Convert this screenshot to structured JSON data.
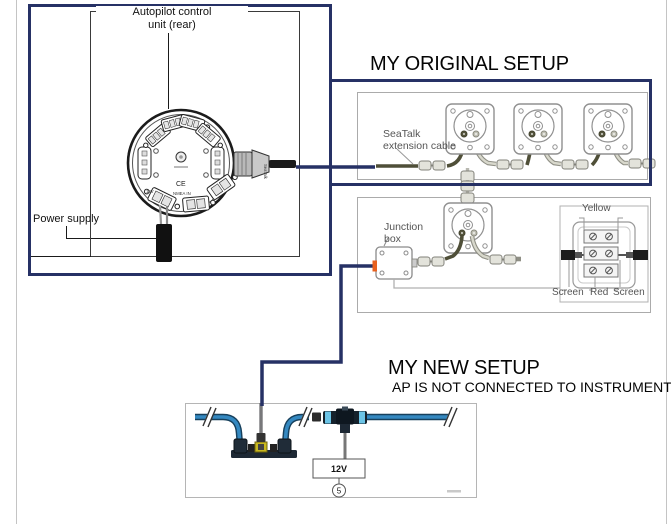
{
  "headings": {
    "original": "MY ORIGINAL SETUP",
    "new": "MY NEW SETUP",
    "new_sub": "AP IS NOT CONNECTED TO INSTRUMENTS"
  },
  "autopilot_box": {
    "title_line1": "Autopilot control",
    "title_line2": "unit (rear)",
    "power_supply_label": "Power supply",
    "unit": {
      "ce": "CE",
      "label_12v": "12V",
      "label_nmea": "NMEA IN",
      "plug": "SeaTalk"
    }
  },
  "original_setup": {
    "cable_label_line1": "SeaTalk",
    "cable_label_line2": "extension cable",
    "junction_label_line1": "Junction",
    "junction_label_line2": "box",
    "inset": {
      "yellow": "Yellow",
      "screen_left": "Screen",
      "red": "Red",
      "screen_right": "Screen",
      "part_number": "D1131"
    }
  },
  "new_setup": {
    "power_label": "12V",
    "callout_number": "5"
  },
  "colors": {
    "annotation_navy": "#263165",
    "junction_highlight_orange": "#e8611f",
    "backbone_blue": "#3488c0",
    "connector_yellow": "#c8b820",
    "diagram_gray": "#ababab"
  }
}
